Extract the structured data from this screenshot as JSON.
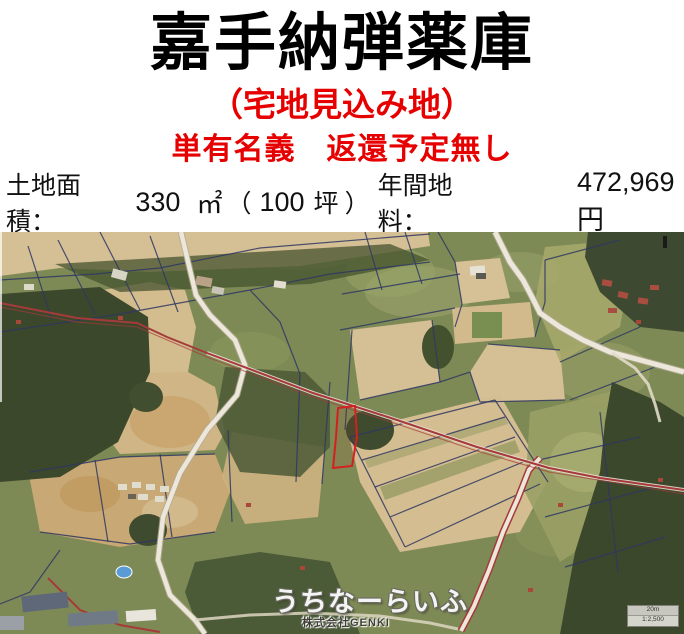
{
  "header": {
    "title": "嘉手納弾薬庫",
    "subtitle": "（宅地見込み地）",
    "ownership_note": "単有名義　返還予定無し",
    "land_info": {
      "area_label": "土地面積：",
      "area_value": "330",
      "area_unit": "㎡",
      "paren_open": "（",
      "tsubo_value": "100",
      "tsubo_unit": "坪",
      "paren_close": "）",
      "rent_label": "年間地料：",
      "rent_value": "472,969円"
    }
  },
  "map": {
    "watermark": "うちなーらいふ",
    "watermark_sub": "株式会社GENKI",
    "scale_label": "20m",
    "scale_ratio": "1:2,500",
    "colors": {
      "accent_red": "#e60000",
      "field_tan": "#d5bf94",
      "vegetation": "#7e8a55",
      "forest_dark": "#3c482c",
      "road_white": "#ece7da",
      "boundary_red": "#a63a3a",
      "parcel_navy": "#2e3763",
      "subject_red": "#d42020",
      "pool_blue": "#5b9bd5"
    }
  }
}
